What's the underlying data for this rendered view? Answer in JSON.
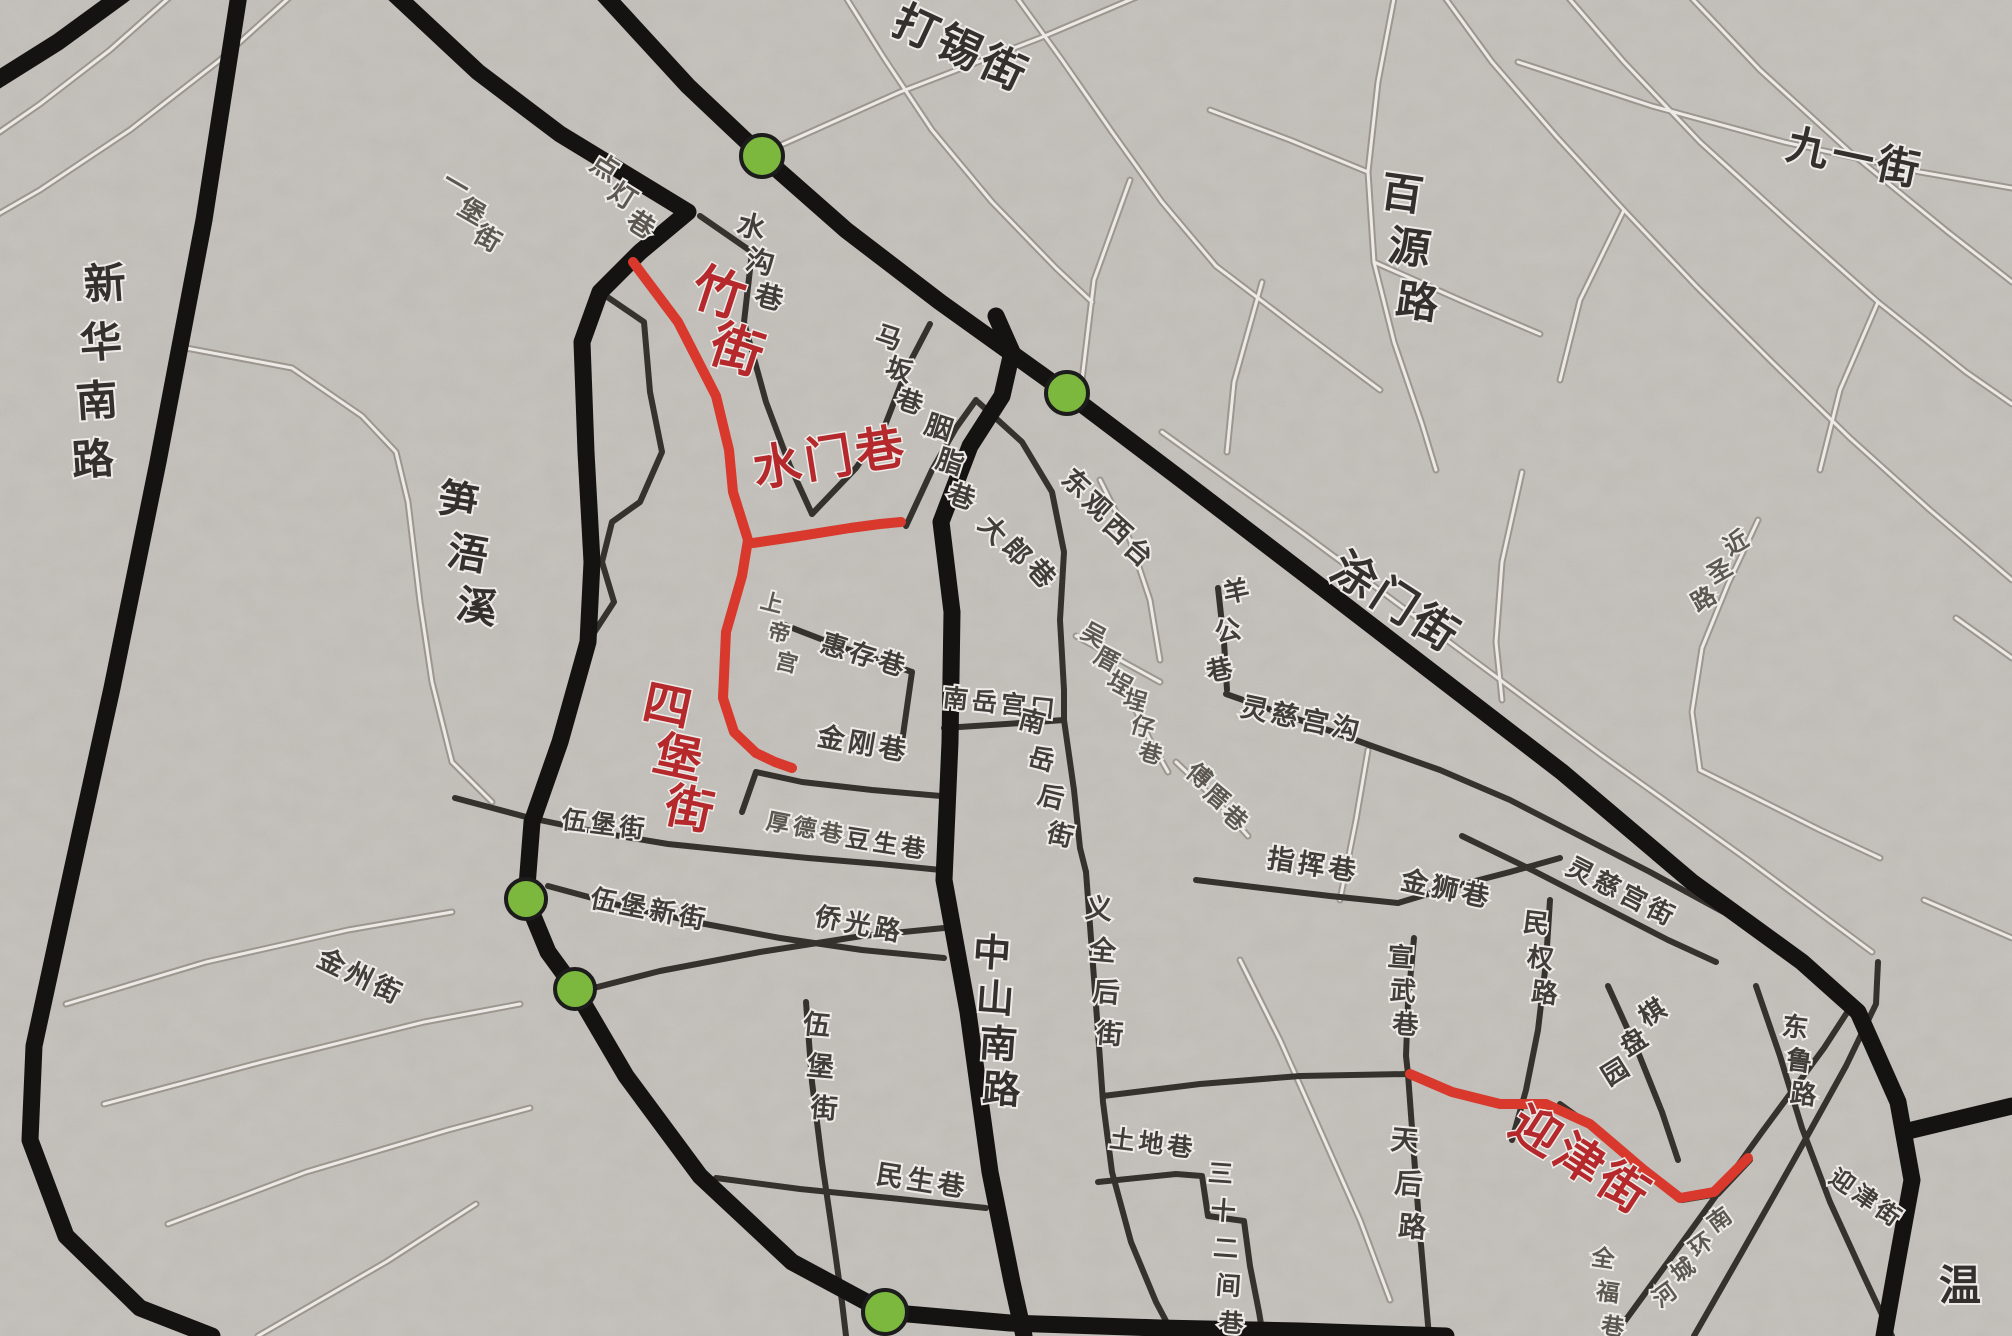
{
  "map": {
    "width": 2012,
    "height": 1336,
    "background_color": "#eae8e5",
    "colors": {
      "trunk_road": "#141311",
      "medium_road": "#35312d",
      "light_road": "#9d968f",
      "light_road_core": "#ece9e6",
      "highlight_route": "#d8392c",
      "highlight_label": "#b5282b",
      "label_dark": "#33302d",
      "label_medium": "#413d39",
      "label_faint": "#5d5751",
      "marker_fill": "#7cb83e",
      "marker_stroke": "#1c1c1c",
      "halo": "#edebe8"
    },
    "highlighted_streets": [
      "竹街",
      "水门巷",
      "四堡街",
      "迎津街"
    ],
    "markers": [
      {
        "id": "junction-dashi-street",
        "x": 762,
        "y": 156,
        "r": 21
      },
      {
        "id": "junction-tumen-street",
        "x": 1067,
        "y": 393,
        "r": 21
      },
      {
        "id": "junction-wubao-north",
        "x": 526,
        "y": 899,
        "r": 20
      },
      {
        "id": "junction-wubao-south",
        "x": 575,
        "y": 989,
        "r": 20
      },
      {
        "id": "junction-south-trunk",
        "x": 885,
        "y": 1312,
        "r": 22
      }
    ],
    "roads": {
      "trunk": [
        {
          "id": "xinhua-south-road",
          "points": "240,-12 204,220 158,462 112,688 66,898 34,1046 30,1140 66,1236 140,1308 212,1336"
        },
        {
          "id": "northwest-corner-road",
          "points": "-12,86 58,42 132,-12"
        },
        {
          "id": "tumen-street-trunk",
          "points": "598,-12 688,86 762,156 846,230 940,302 1067,393 1178,477 1302,572 1432,672 1562,772 1692,882 1802,962 1858,1012 1898,1102 1912,1180 1896,1268 1884,1336"
        },
        {
          "id": "east-branch-road",
          "points": "1904,1132 2012,1106"
        },
        {
          "id": "zhongshan-south-road",
          "points": "996,316 1012,352 1002,396 970,446 941,522 952,612 950,742 944,880 968,1012 990,1172 1012,1282 1024,1336"
        },
        {
          "id": "inner-west-ring-road",
          "points": "388,-12 478,72 560,134 688,212 640,252 600,292 582,342 586,452 592,562 588,642 560,742 532,822 526,899 548,952 575,989 626,1076 700,1176 792,1262 885,1312 1010,1323 1160,1328 1300,1331 1446,1336"
        }
      ],
      "medium": [
        {
          "id": "shuigou-lane-road",
          "points": "700,216 752,252 744,322 766,402 790,466 812,514"
        },
        {
          "id": "maban-lane-road",
          "points": "812,514 856,468 884,428 908,366 930,324"
        },
        {
          "id": "yanzhi-lane-road",
          "points": "906,526 932,470 956,428 976,400"
        },
        {
          "id": "west-block-edge",
          "points": "600,292 644,322 650,392 662,452 640,502 612,522 602,562 614,602 588,642"
        },
        {
          "id": "huicun-lane-road",
          "points": "782,624 844,648 912,672"
        },
        {
          "id": "huicun-block-edge",
          "points": "912,672 902,742"
        },
        {
          "id": "jingang-lane-road",
          "points": "756,772 802,782 872,790 941,796"
        },
        {
          "id": "jingang-west-bend",
          "points": "756,772 742,812"
        },
        {
          "id": "nanyue-gongkou-road",
          "points": "944,728 1006,724 1064,720"
        },
        {
          "id": "nanyue-back-street-road",
          "points": "1064,720 1074,790 1080,848 1086,872"
        },
        {
          "id": "east-big-block-edge",
          "points": "978,402 1022,442 1052,492 1064,552 1060,620 1064,690 1064,720"
        },
        {
          "id": "zhihui-lane-road",
          "points": "1196,880 1262,888 1330,896 1398,903"
        },
        {
          "id": "minquan-road-road",
          "points": "1550,900 1546,962 1538,1030 1526,1090 1512,1140"
        },
        {
          "id": "xuanwu-lane-road",
          "points": "1414,938 1408,1002 1406,1056 1408,1074"
        },
        {
          "id": "jinshi-lane-road",
          "points": "1398,903 1448,888 1510,872 1560,858"
        },
        {
          "id": "lingci-gonggou-road",
          "points": "1226,694 1300,720 1372,746 1440,770 1510,800 1580,836 1650,872 1716,908 1772,938"
        },
        {
          "id": "yanggong-lane-road",
          "points": "1218,588 1224,642 1227,690"
        },
        {
          "id": "wubao-street-road",
          "points": "455,798 530,818 602,833 668,844 736,851 808,858 880,864 941,870"
        },
        {
          "id": "wubao-new-street-road",
          "points": "548,886 622,906 700,923 780,938 862,950 944,958"
        },
        {
          "id": "qiaoguang-road-road",
          "points": "578,992 660,971 760,952 862,936 944,928"
        },
        {
          "id": "minsheng-lane-road",
          "points": "716,1178 800,1189 900,1199 986,1208"
        },
        {
          "id": "wubao-vertical-road",
          "points": "806,1002 812,1082 822,1162 834,1244 842,1302 846,1336"
        },
        {
          "id": "yiquan-back-street-road",
          "points": "1086,872 1092,952 1098,1032 1103,1102 1112,1172 1131,1242 1156,1302 1174,1336"
        },
        {
          "id": "tudi-lane-road",
          "points": "1098,1182 1176,1174 1202,1176 1208,1216 1244,1221 1250,1266 1259,1312 1263,1336"
        },
        {
          "id": "tianhou-road-road",
          "points": "1408,1074 1413,1142 1419,1222 1426,1302 1429,1336"
        },
        {
          "id": "cross-road-to-tianhou",
          "points": "1103,1096 1200,1084 1300,1076 1408,1074"
        },
        {
          "id": "s-curve-road-1",
          "points": "1694,1336 1742,1252 1794,1160 1846,1066 1876,1004 1878,962"
        },
        {
          "id": "s-curve-road-2",
          "points": "1614,1336 1684,1240 1762,1132 1824,1048 1850,1008"
        },
        {
          "id": "donglu-road-road",
          "points": "1756,986 1780,1056 1802,1128 1830,1202 1862,1272 1892,1336"
        },
        {
          "id": "lingci-gong-street-road",
          "points": "1462,836 1532,870 1602,906 1668,940 1716,962"
        },
        {
          "id": "qipanyuan-road",
          "points": "1608,986 1638,1052 1662,1112 1678,1160"
        },
        {
          "id": "yingjin-street-base-road",
          "points": "1560,1104 1610,1140 1656,1178 1682,1200 1718,1194 1750,1160"
        }
      ],
      "light": [
        {
          "id": "levee-road",
          "points": "186,348 292,368 362,416 396,452 408,502 420,602 432,682 452,762 492,802"
        },
        {
          "id": "nw-lane-1",
          "points": "300,-12 220,60 130,130 40,190 -12,220"
        },
        {
          "id": "nw-lane-2",
          "points": "180,-12 110,50 40,104 -12,140"
        },
        {
          "id": "daxi-street-road",
          "points": "770,150 900,92 1040,38 1158,-12"
        },
        {
          "id": "top-center-lane-1",
          "points": "840,-12 884,58 932,130 992,202 1056,268 1092,302"
        },
        {
          "id": "top-center-lane-2",
          "points": "1010,-12 1062,60 1112,132 1162,202 1216,266"
        },
        {
          "id": "baiyuan-road-road",
          "points": "1396,-12 1378,82 1368,172 1374,262 1394,342 1422,424 1436,470"
        },
        {
          "id": "jiuyi-street-road",
          "points": "1518,62 1652,106 1784,142 1920,172 2012,188"
        },
        {
          "id": "ne-lane-1",
          "points": "1438,-12 1492,62 1556,136 1624,210 1696,286 1772,362 1850,438 1930,510 2012,580"
        },
        {
          "id": "ne-lane-2",
          "points": "1560,-12 1624,62 1700,142 1788,222 1878,302 1966,372 2012,404"
        },
        {
          "id": "ne-lane-3",
          "points": "1682,-12 1760,70 1850,152 1948,232 2012,282"
        },
        {
          "id": "ne-cross-1",
          "points": "1130,180 1094,280 1082,380"
        },
        {
          "id": "ne-cross-2",
          "points": "1262,282 1234,382 1227,452"
        },
        {
          "id": "ne-cross-3",
          "points": "1522,472 1502,562 1496,642 1502,700"
        },
        {
          "id": "ne-cross-4",
          "points": "1624,210 1580,300 1560,380"
        },
        {
          "id": "ne-cross-5",
          "points": "1878,302 1840,390 1820,470"
        },
        {
          "id": "ne-cross-6",
          "points": "1374,262 1460,300 1540,334"
        },
        {
          "id": "ne-cross-7",
          "points": "1368,172 1290,140 1210,110"
        },
        {
          "id": "ne-cross-8",
          "points": "1216,266 1300,330 1380,390"
        },
        {
          "id": "jinsheng-road-road",
          "points": "1758,520 1728,584 1702,648 1692,712 1700,770"
        },
        {
          "id": "jinsheng-connector",
          "points": "1700,770 1760,800 1820,830 1880,858"
        },
        {
          "id": "back-lane-parallel",
          "points": "1162,432 1304,534 1452,644 1600,754 1748,860 1872,952"
        },
        {
          "id": "sw-lane-1",
          "points": "66,1004 206,962 348,930 452,912"
        },
        {
          "id": "sw-lane-2",
          "points": "104,1104 262,1062 424,1022 520,1004"
        },
        {
          "id": "jinzhou-street-road",
          "points": "168,1224 306,1172 448,1130 530,1108"
        },
        {
          "id": "sw-lane-3",
          "points": "258,1336 386,1262 476,1204"
        },
        {
          "id": "wuce-road",
          "points": "1076,636 1120,660 1160,682"
        },
        {
          "id": "chengzai-road",
          "points": "1130,698 1150,740 1168,772"
        },
        {
          "id": "fuce-road",
          "points": "1176,762 1216,800 1248,836"
        },
        {
          "id": "dongguan-road",
          "points": "1100,480 1130,540 1150,600 1160,660"
        },
        {
          "id": "zhihui-connector",
          "points": "1340,900 1356,820 1368,750"
        },
        {
          "id": "tianhou-west-lane",
          "points": "1240,960 1280,1040 1320,1130 1360,1220 1390,1300"
        },
        {
          "id": "right-mid-lane-1",
          "points": "1924,900 2012,938"
        },
        {
          "id": "right-mid-lane-2",
          "points": "1956,618 2012,658"
        }
      ],
      "highlight": [
        {
          "id": "zhu-street-sibao-street-route",
          "points": "633,262 678,322 716,396 729,450 733,492 748,540 742,576 726,632 723,698 734,732 756,753 775,762 792,768"
        },
        {
          "id": "shuimen-lane-route",
          "points": "753,543 800,536 850,528 880,524 901,522"
        },
        {
          "id": "yingjin-street-route",
          "points": "1410,1074 1452,1092 1500,1104 1546,1104 1590,1124 1644,1170 1680,1198 1714,1192 1748,1158"
        }
      ]
    },
    "labels": [
      {
        "text": "竹街",
        "x": 713,
        "y": 310,
        "rot": 18,
        "dir": "v",
        "size": 52,
        "cls": "hl",
        "gap": 1.15
      },
      {
        "text": "水门巷",
        "x": 833,
        "y": 474,
        "rot": -9,
        "dir": "h",
        "size": 48,
        "cls": "hl"
      },
      {
        "text": "四堡街",
        "x": 664,
        "y": 722,
        "rot": 12,
        "dir": "v",
        "size": 48,
        "cls": "hl",
        "gap": 1.1
      },
      {
        "text": "迎津街",
        "x": 1572,
        "y": 1174,
        "rot": 33,
        "dir": "h",
        "size": 48,
        "cls": "hl"
      },
      {
        "text": "打锡街",
        "x": 955,
        "y": 62,
        "rot": 25,
        "dir": "h",
        "size": 44,
        "cls": "lg"
      },
      {
        "text": "九一街",
        "x": 1852,
        "y": 172,
        "rot": 12,
        "dir": "h",
        "size": 42,
        "cls": "lg"
      },
      {
        "text": "百源路",
        "x": 1400,
        "y": 208,
        "rot": 8,
        "dir": "v",
        "size": 42,
        "cls": "lg",
        "gap": 1.3
      },
      {
        "text": "新华南路",
        "x": 106,
        "y": 298,
        "rot": -4,
        "dir": "v",
        "size": 42,
        "cls": "lg",
        "gap": 1.4
      },
      {
        "text": "笋浯溪",
        "x": 456,
        "y": 514,
        "rot": 10,
        "dir": "v",
        "size": 40,
        "cls": "lg",
        "gap": 1.35
      },
      {
        "text": "涂门街",
        "x": 1388,
        "y": 615,
        "rot": 33,
        "dir": "h",
        "size": 44,
        "cls": "lg"
      },
      {
        "text": "中山南路",
        "x": 991,
        "y": 966,
        "rot": 4,
        "dir": "v",
        "size": 38,
        "cls": "lg",
        "gap": 1.2
      },
      {
        "text": "温",
        "x": 1962,
        "y": 1300,
        "rot": 0,
        "dir": "h",
        "size": 42,
        "cls": "lg"
      },
      {
        "text": "点灯巷",
        "x": 600,
        "y": 175,
        "rot": 32,
        "dir": "v",
        "size": 27,
        "cls": "sm",
        "gap": 1.25
      },
      {
        "text": "一堡街",
        "x": 452,
        "y": 192,
        "rot": 30,
        "dir": "v",
        "size": 26,
        "cls": "sm",
        "gap": 1.2
      },
      {
        "text": "水沟巷",
        "x": 749,
        "y": 236,
        "rot": 14,
        "dir": "v",
        "size": 28,
        "cls": "md",
        "gap": 1.3
      },
      {
        "text": "马坂巷",
        "x": 886,
        "y": 346,
        "rot": 18,
        "dir": "v",
        "size": 26,
        "cls": "md",
        "gap": 1.3
      },
      {
        "text": "胭脂巷",
        "x": 936,
        "y": 436,
        "rot": 18,
        "dir": "v",
        "size": 27,
        "cls": "md",
        "gap": 1.35
      },
      {
        "text": "大郎巷",
        "x": 986,
        "y": 536,
        "rot": 48,
        "dir": "v",
        "size": 27,
        "cls": "md",
        "gap": 1.2
      },
      {
        "text": "东观西台",
        "x": 1070,
        "y": 490,
        "rot": 42,
        "dir": "v",
        "size": 27,
        "cls": "md",
        "gap": 1.15
      },
      {
        "text": "上帝宫",
        "x": 770,
        "y": 610,
        "rot": 14,
        "dir": "v",
        "size": 22,
        "cls": "sm",
        "gap": 1.4
      },
      {
        "text": "羊公巷",
        "x": 1238,
        "y": 600,
        "rot": -12,
        "dir": "v",
        "size": 26,
        "cls": "md",
        "gap": 1.55
      },
      {
        "text": "灵慈宫沟",
        "x": 1300,
        "y": 728,
        "rot": 12,
        "dir": "h",
        "size": 27,
        "cls": "md"
      },
      {
        "text": "惠存巷",
        "x": 862,
        "y": 664,
        "rot": 17,
        "dir": "h",
        "size": 26,
        "cls": "md"
      },
      {
        "text": "金刚巷",
        "x": 862,
        "y": 753,
        "rot": 10,
        "dir": "h",
        "size": 27,
        "cls": "md"
      },
      {
        "text": "南岳宫口",
        "x": 1000,
        "y": 712,
        "rot": 6,
        "dir": "h",
        "size": 25,
        "cls": "md"
      },
      {
        "text": "南岳后街",
        "x": 1030,
        "y": 730,
        "rot": 14,
        "dir": "v",
        "size": 26,
        "cls": "md",
        "gap": 1.5
      },
      {
        "text": "吴厝埕",
        "x": 1090,
        "y": 642,
        "rot": 28,
        "dir": "v",
        "size": 24,
        "cls": "sm",
        "gap": 1.15
      },
      {
        "text": "埕仔巷",
        "x": 1133,
        "y": 708,
        "rot": 16,
        "dir": "v",
        "size": 23,
        "cls": "sm",
        "gap": 1.2
      },
      {
        "text": "傅厝巷",
        "x": 1194,
        "y": 782,
        "rot": 40,
        "dir": "v",
        "size": 24,
        "cls": "sm",
        "gap": 1.15
      },
      {
        "text": "指挥巷",
        "x": 1312,
        "y": 874,
        "rot": 9,
        "dir": "h",
        "size": 27,
        "cls": "md"
      },
      {
        "text": "金狮巷",
        "x": 1445,
        "y": 898,
        "rot": 12,
        "dir": "h",
        "size": 27,
        "cls": "md"
      },
      {
        "text": "灵慈宫街",
        "x": 1618,
        "y": 900,
        "rot": 27,
        "dir": "h",
        "size": 26,
        "cls": "md"
      },
      {
        "text": "民权路",
        "x": 1535,
        "y": 932,
        "rot": 7,
        "dir": "v",
        "size": 26,
        "cls": "md",
        "gap": 1.35
      },
      {
        "text": "宣武巷",
        "x": 1400,
        "y": 966,
        "rot": 4,
        "dir": "v",
        "size": 26,
        "cls": "md",
        "gap": 1.3
      },
      {
        "text": "棋盘园",
        "x": 1657,
        "y": 1020,
        "rot": -32,
        "dir": "v",
        "size": 26,
        "cls": "md",
        "gap": 1.35
      },
      {
        "text": "东鲁路",
        "x": 1794,
        "y": 1036,
        "rot": 7,
        "dir": "v",
        "size": 26,
        "cls": "md",
        "gap": 1.3
      },
      {
        "text": "迎津街",
        "x": 1862,
        "y": 1205,
        "rot": 35,
        "dir": "h",
        "size": 24,
        "cls": "md"
      },
      {
        "text": "天后路",
        "x": 1404,
        "y": 1150,
        "rot": 5,
        "dir": "v",
        "size": 28,
        "cls": "md",
        "gap": 1.55
      },
      {
        "text": "伍堡街",
        "x": 604,
        "y": 833,
        "rot": 7,
        "dir": "h",
        "size": 25,
        "cls": "md"
      },
      {
        "text": "伍堡新街",
        "x": 648,
        "y": 918,
        "rot": 11,
        "dir": "h",
        "size": 26,
        "cls": "md"
      },
      {
        "text": "厚德巷",
        "x": 805,
        "y": 836,
        "rot": 11,
        "dir": "h",
        "size": 23,
        "cls": "sm"
      },
      {
        "text": "豆生巷",
        "x": 886,
        "y": 852,
        "rot": 9,
        "dir": "h",
        "size": 24,
        "cls": "md"
      },
      {
        "text": "侨光路",
        "x": 858,
        "y": 933,
        "rot": 11,
        "dir": "h",
        "size": 26,
        "cls": "md"
      },
      {
        "text": "伍堡街",
        "x": 816,
        "y": 1034,
        "rot": 5,
        "dir": "v",
        "size": 27,
        "cls": "md",
        "gap": 1.55
      },
      {
        "text": "民生巷",
        "x": 921,
        "y": 1190,
        "rot": 9,
        "dir": "h",
        "size": 27,
        "cls": "md"
      },
      {
        "text": "义全后街",
        "x": 1098,
        "y": 918,
        "rot": 5,
        "dir": "v",
        "size": 27,
        "cls": "md",
        "gap": 1.55
      },
      {
        "text": "土地巷",
        "x": 1152,
        "y": 1152,
        "rot": 7,
        "dir": "h",
        "size": 25,
        "cls": "md"
      },
      {
        "text": "三十二间巷",
        "x": 1220,
        "y": 1182,
        "rot": 4,
        "dir": "v",
        "size": 25,
        "cls": "md",
        "gap": 1.5
      },
      {
        "text": "金州街",
        "x": 357,
        "y": 985,
        "rot": 26,
        "dir": "h",
        "size": 27,
        "cls": "md"
      },
      {
        "text": "近圣路",
        "x": 1740,
        "y": 550,
        "rot": -30,
        "dir": "v",
        "size": 24,
        "cls": "sm",
        "gap": 1.35
      },
      {
        "text": "南环城河",
        "x": 1724,
        "y": 1226,
        "rot": -36,
        "dir": "v",
        "size": 23,
        "cls": "sm",
        "gap": 1.35
      },
      {
        "text": "全福巷",
        "x": 1602,
        "y": 1266,
        "rot": 8,
        "dir": "v",
        "size": 23,
        "cls": "sm",
        "gap": 1.5
      }
    ]
  }
}
